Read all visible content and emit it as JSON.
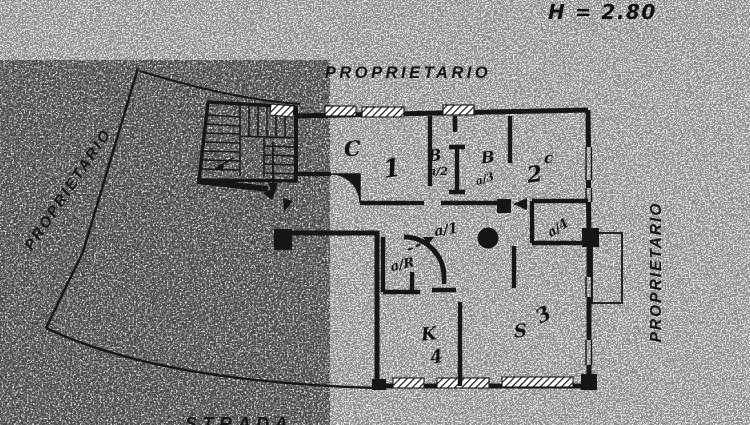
{
  "document": {
    "type": "scanned floor plan",
    "colors": {
      "ink": "#161616",
      "paper": "#fcfcfa"
    }
  },
  "annotations": {
    "height_note": "H = 2.80",
    "owner_top": "PROPRIETARIO",
    "owner_left": "PROPRIETARIO",
    "owner_right": "PROPRIETARIO",
    "street": "STRADA"
  },
  "rooms": {
    "room1_type": "C",
    "room1_num": "1",
    "bath1_type": "B",
    "bath1_code": "a/2",
    "bath2_type": "B",
    "bath2_code": "a/3",
    "room2_num": "2",
    "room2_type": "c",
    "hall_code": "a/1",
    "storage_code": "a/4",
    "closet_code": "a/R",
    "kitchen_type": "K",
    "kitchen_num": "4",
    "living_type": "S",
    "living_num": "3"
  }
}
